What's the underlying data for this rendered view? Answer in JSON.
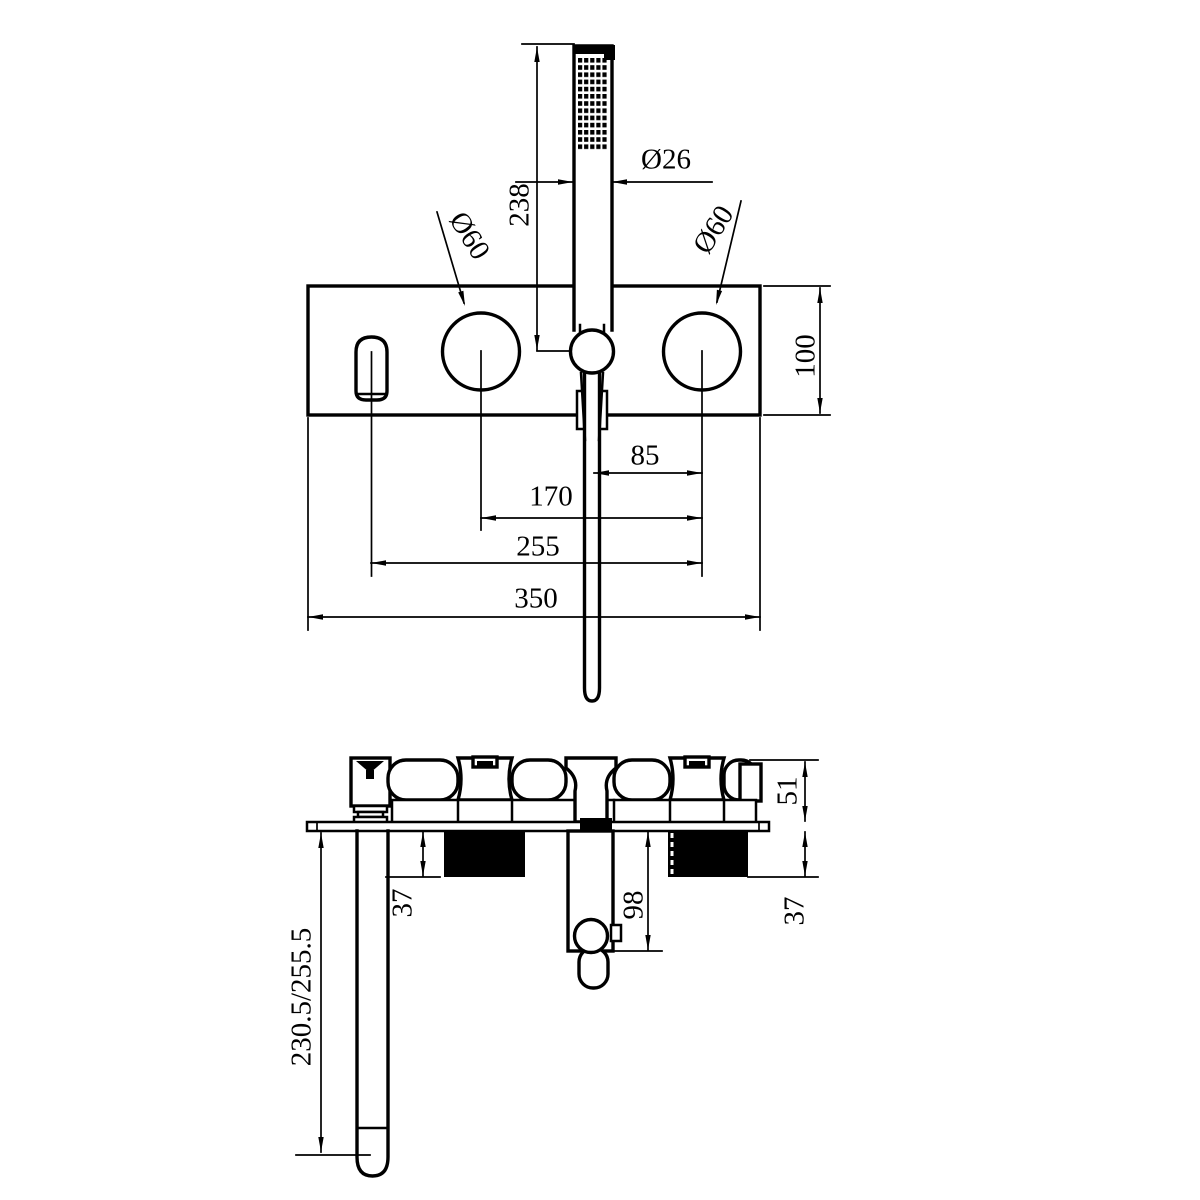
{
  "front_view": {
    "labels": {
      "handshower_height": "238",
      "handshower_diameter": "Ø26",
      "left_knob_diameter": "Ø60",
      "right_knob_diameter": "Ø60",
      "plate_height": "100",
      "hose_to_right_knob": "85",
      "left_to_right_knob": "170",
      "spout_to_right_knob": "255",
      "plate_width": "350"
    }
  },
  "side_view": {
    "labels": {
      "body_depth": "51",
      "left_cartridge_depth": "37",
      "right_cartridge_depth": "37",
      "hose_outlet_depth": "98",
      "spout_length": "230.5/255.5"
    }
  },
  "colors": {
    "line": "#000000",
    "background": "#ffffff"
  }
}
